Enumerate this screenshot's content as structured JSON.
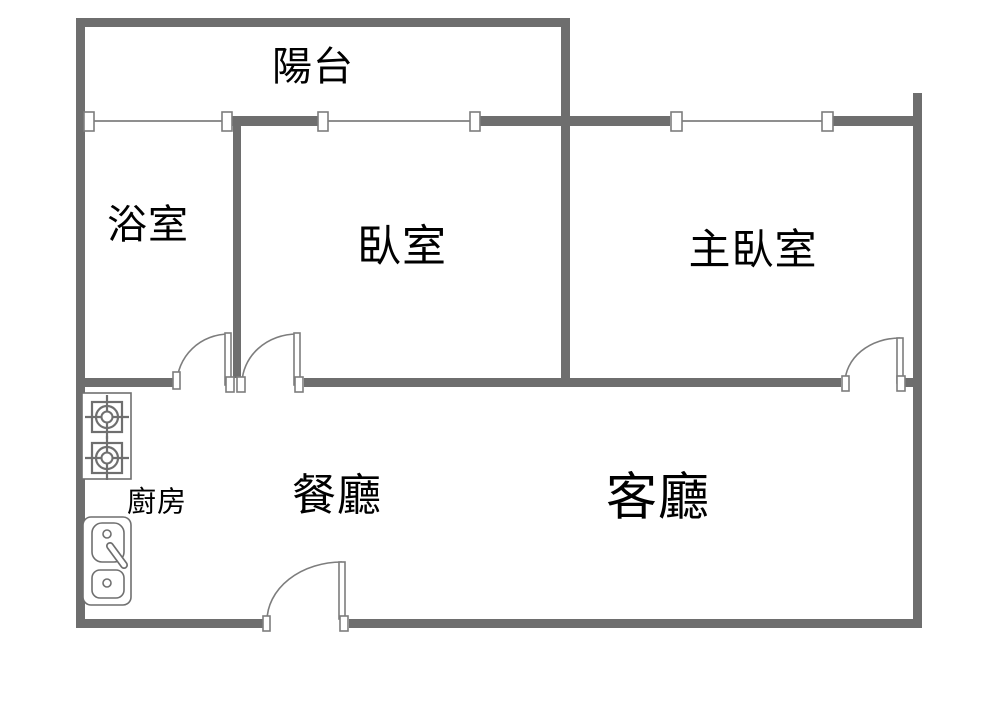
{
  "document": {
    "type": "apartment-floor-plan"
  },
  "colors": {
    "bg": "#ffffff",
    "wall": "#6e6e6e",
    "line": "#8f8f8f",
    "door": "#7d7d7d",
    "fixture": "#6f6f6f",
    "text": "#000000"
  },
  "rooms": {
    "balcony": {
      "label": "陽台"
    },
    "bathroom": {
      "label": "浴室"
    },
    "bedroom": {
      "label": "臥室"
    },
    "master_bedroom": {
      "label": "主臥室"
    },
    "kitchen": {
      "label": "廚房"
    },
    "dining_room": {
      "label": "餐廳"
    },
    "living_room": {
      "label": "客廳"
    }
  },
  "icons": {
    "stove": "stove-two-burners-icon",
    "sink": "double-basin-sink-icon",
    "window": "window-segment-icon",
    "door": "door-swing-arc-icon"
  }
}
